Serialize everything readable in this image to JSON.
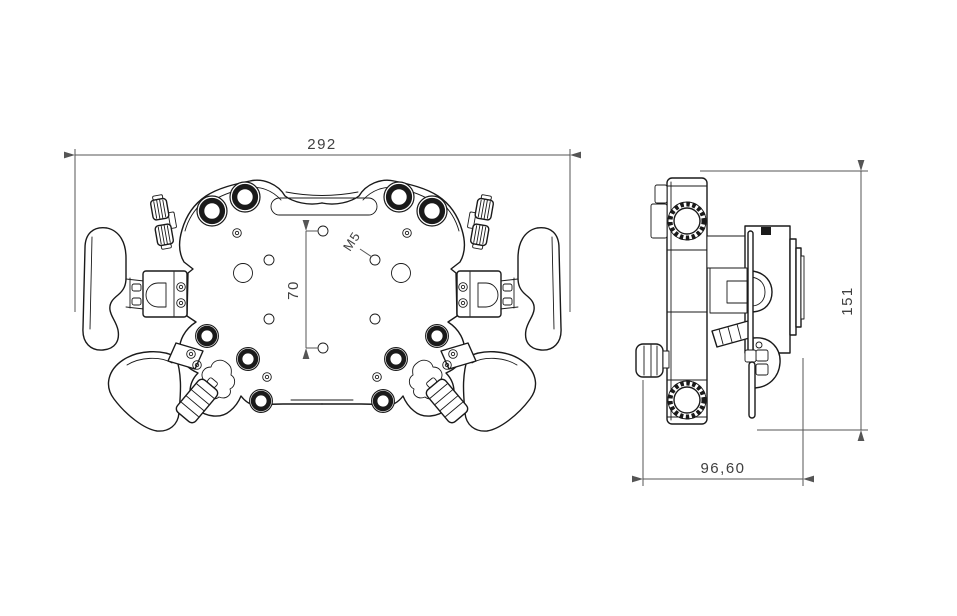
{
  "document": {
    "kind": "technical-drawing",
    "background": "#ffffff",
    "edge_color": "#1a1a1a",
    "dim_color": "#555555",
    "text_color": "#404040"
  },
  "front_view": {
    "dim_overall_width": "292",
    "dim_mount_hole_spacing": "70",
    "thread_callout": "M5"
  },
  "side_view": {
    "dim_overall_height": "151",
    "dim_overall_depth": "96,60"
  }
}
